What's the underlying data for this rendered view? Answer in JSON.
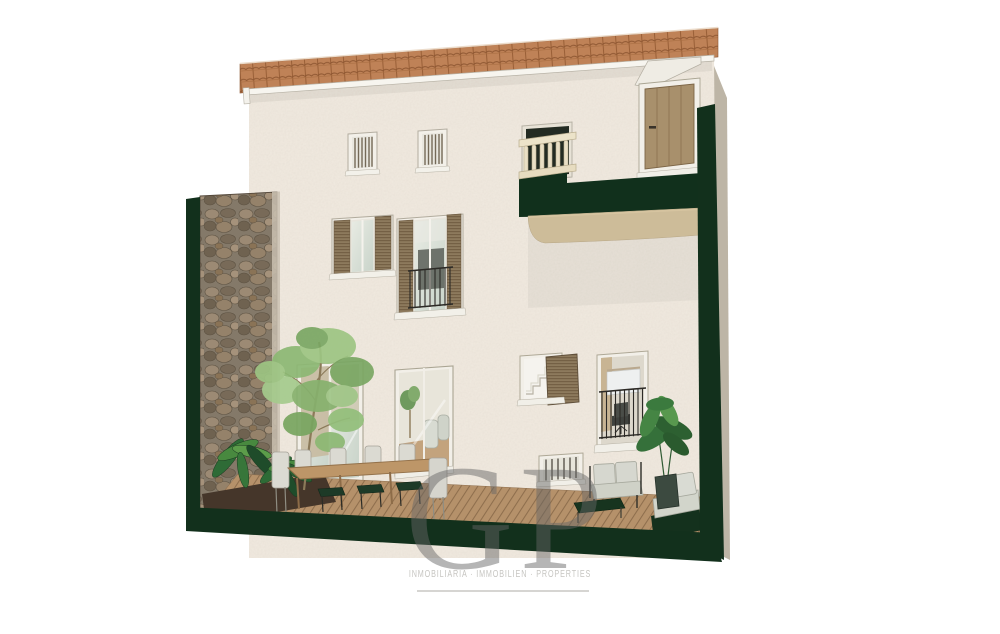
{
  "watermark": {
    "logo_text": "GP",
    "tagline": "INMOBILIARIA · IMMOBILIEN · PROPERTIES"
  },
  "scene": {
    "type": "architectural-section-render",
    "subject": "three-storey townhouse rear elevation with patio terrace, section cuts shown in dark green",
    "elements": [
      "tiled roof",
      "stucco facade",
      "stone patio wall",
      "wood deck terrace",
      "dining table with chairs",
      "lounge sofa set",
      "potted plants",
      "tree",
      "shuttered windows",
      "juliet balcony",
      "wooden door",
      "stone balustrade"
    ]
  },
  "colors": {
    "background": "#ffffff",
    "section_cut_green": "#12301c",
    "facade_cream": "#f1eae0",
    "roof_terracotta": "#bf8257",
    "deck_wood": "#b5916a",
    "stone_wall": "#847969",
    "shutter_brown": "#8d7a5d",
    "watermark_gray": "#666666",
    "tagline_gray": "#c6c5c1"
  }
}
